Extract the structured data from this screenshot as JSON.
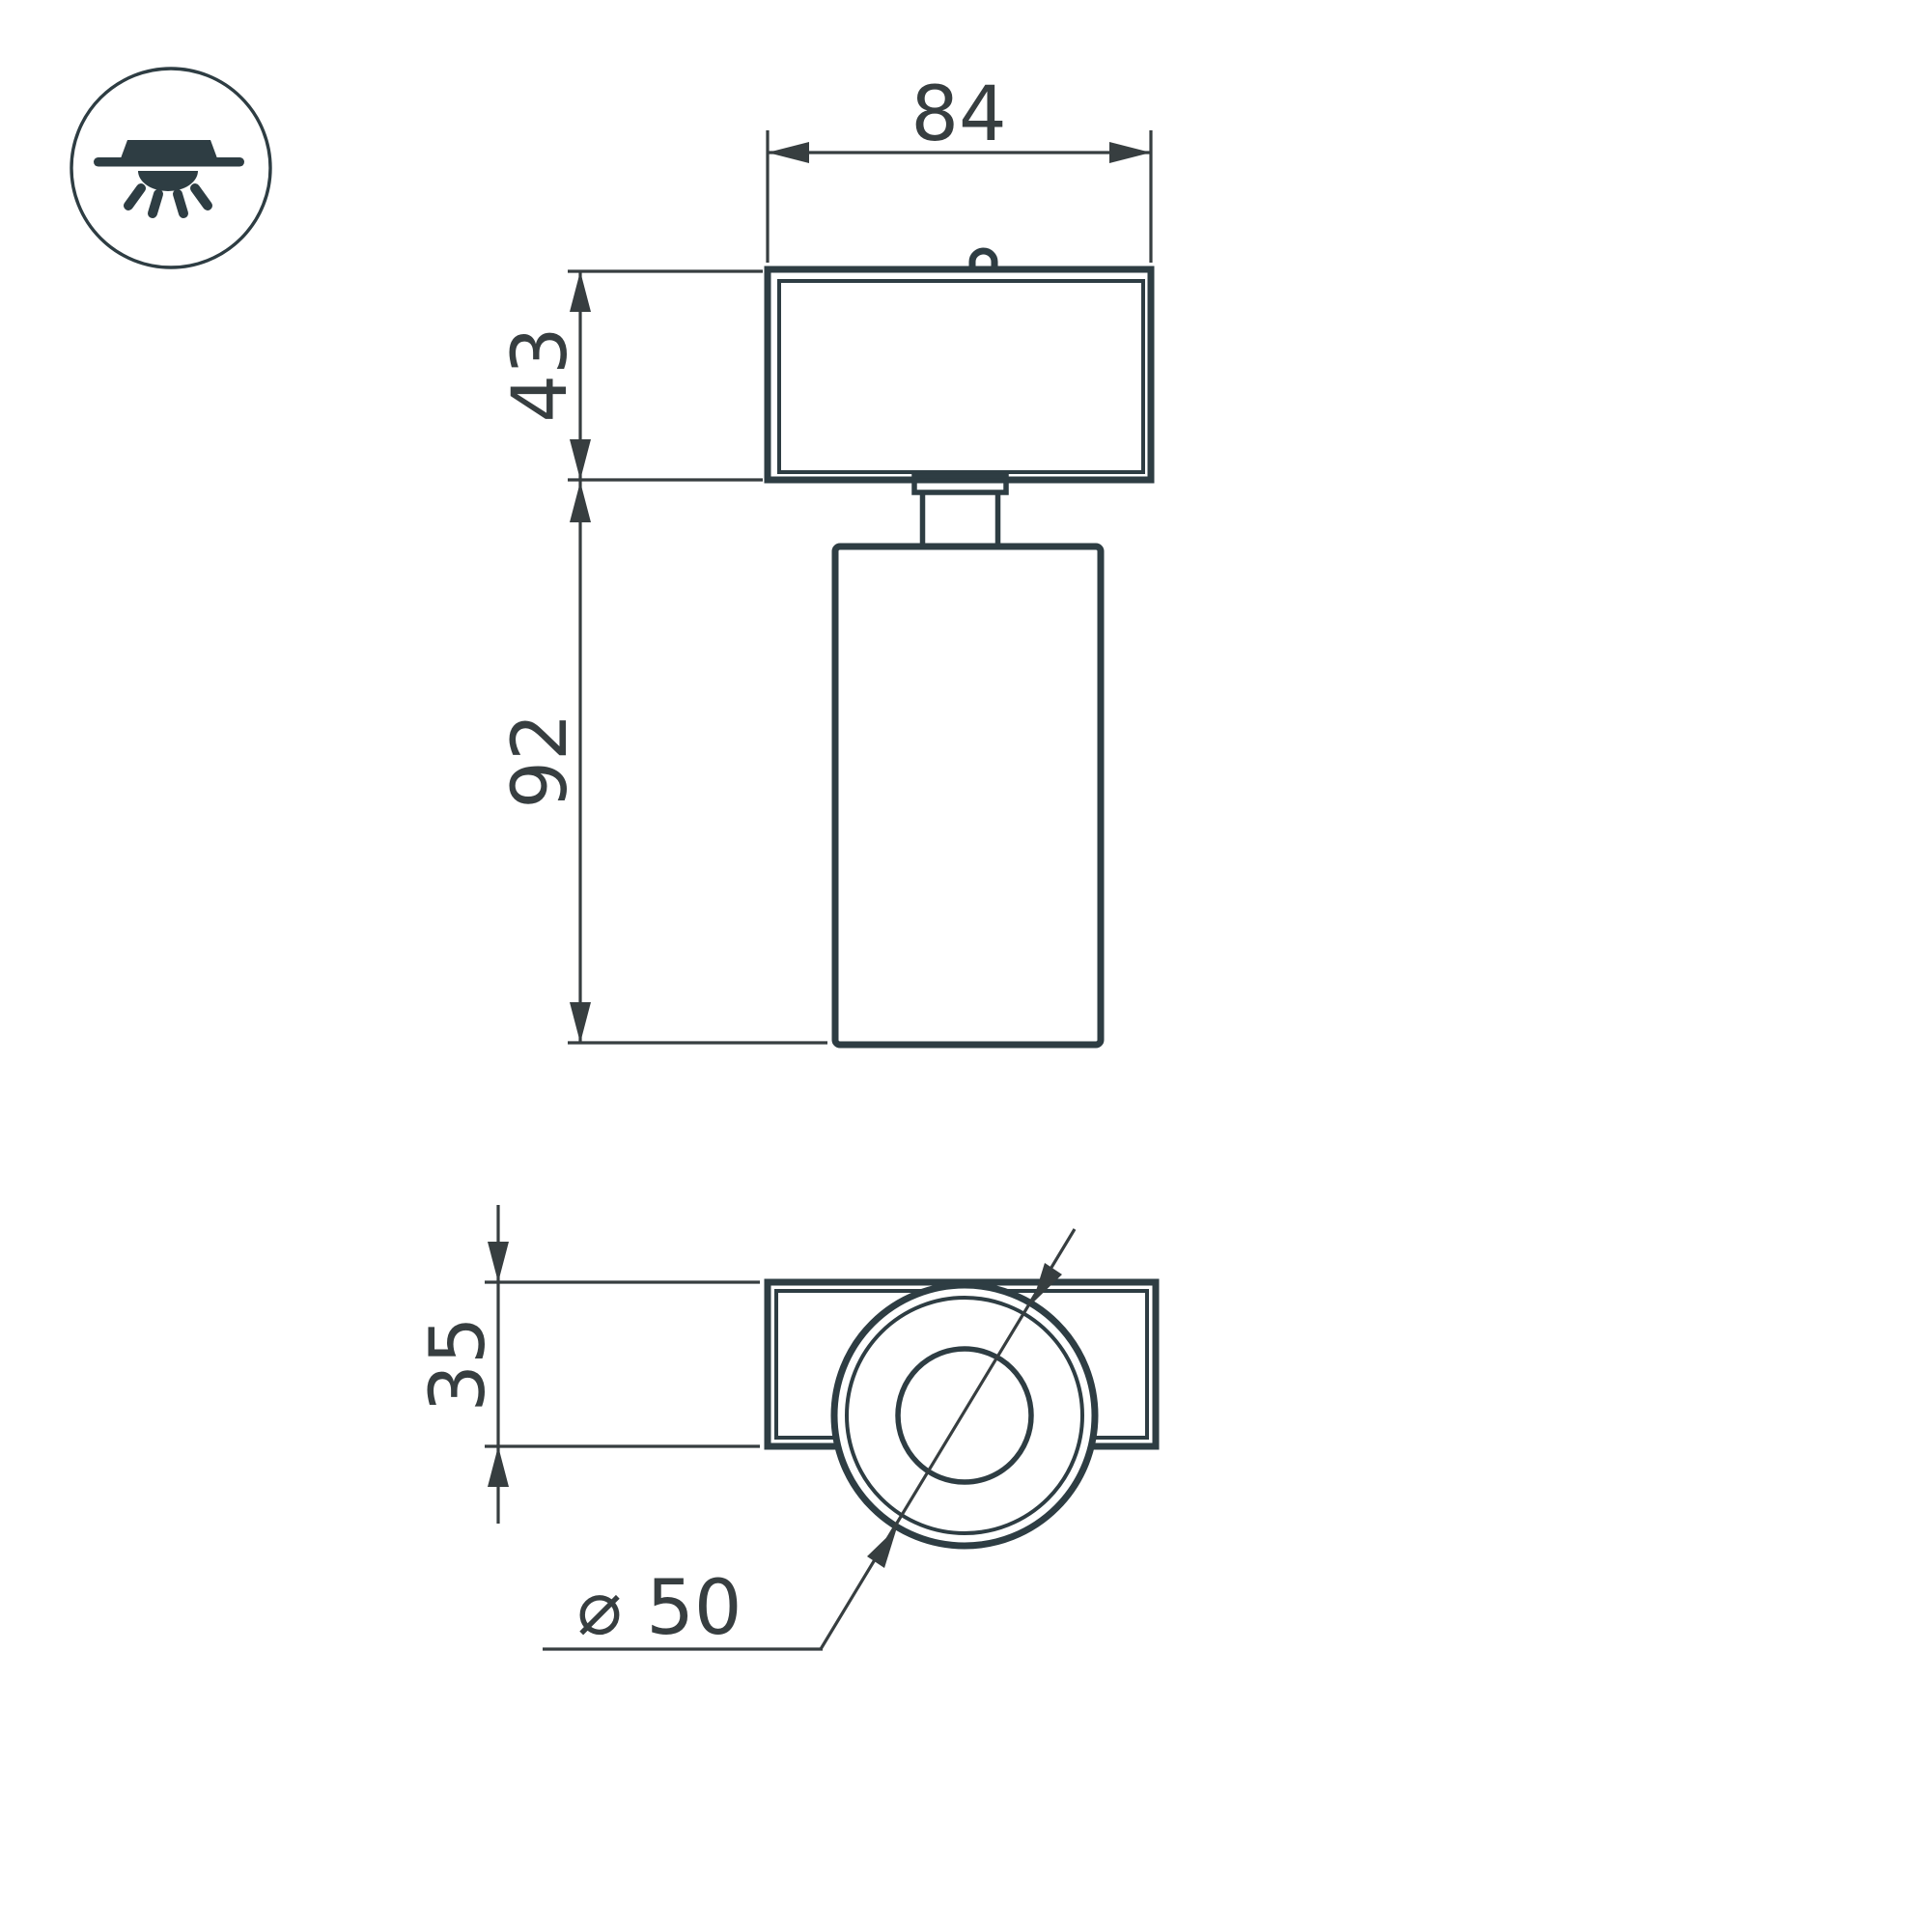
{
  "drawing": {
    "background_color": "#ffffff",
    "ink_color": "#2e3d43",
    "dim_line_color": "#373e40",
    "dimensions": {
      "base_width": "84",
      "base_height": "43",
      "body_height": "92",
      "plate_depth": "35",
      "diameter": "⌀ 50"
    },
    "icon": {
      "name": "surface-mount-ceiling-light-icon"
    }
  }
}
